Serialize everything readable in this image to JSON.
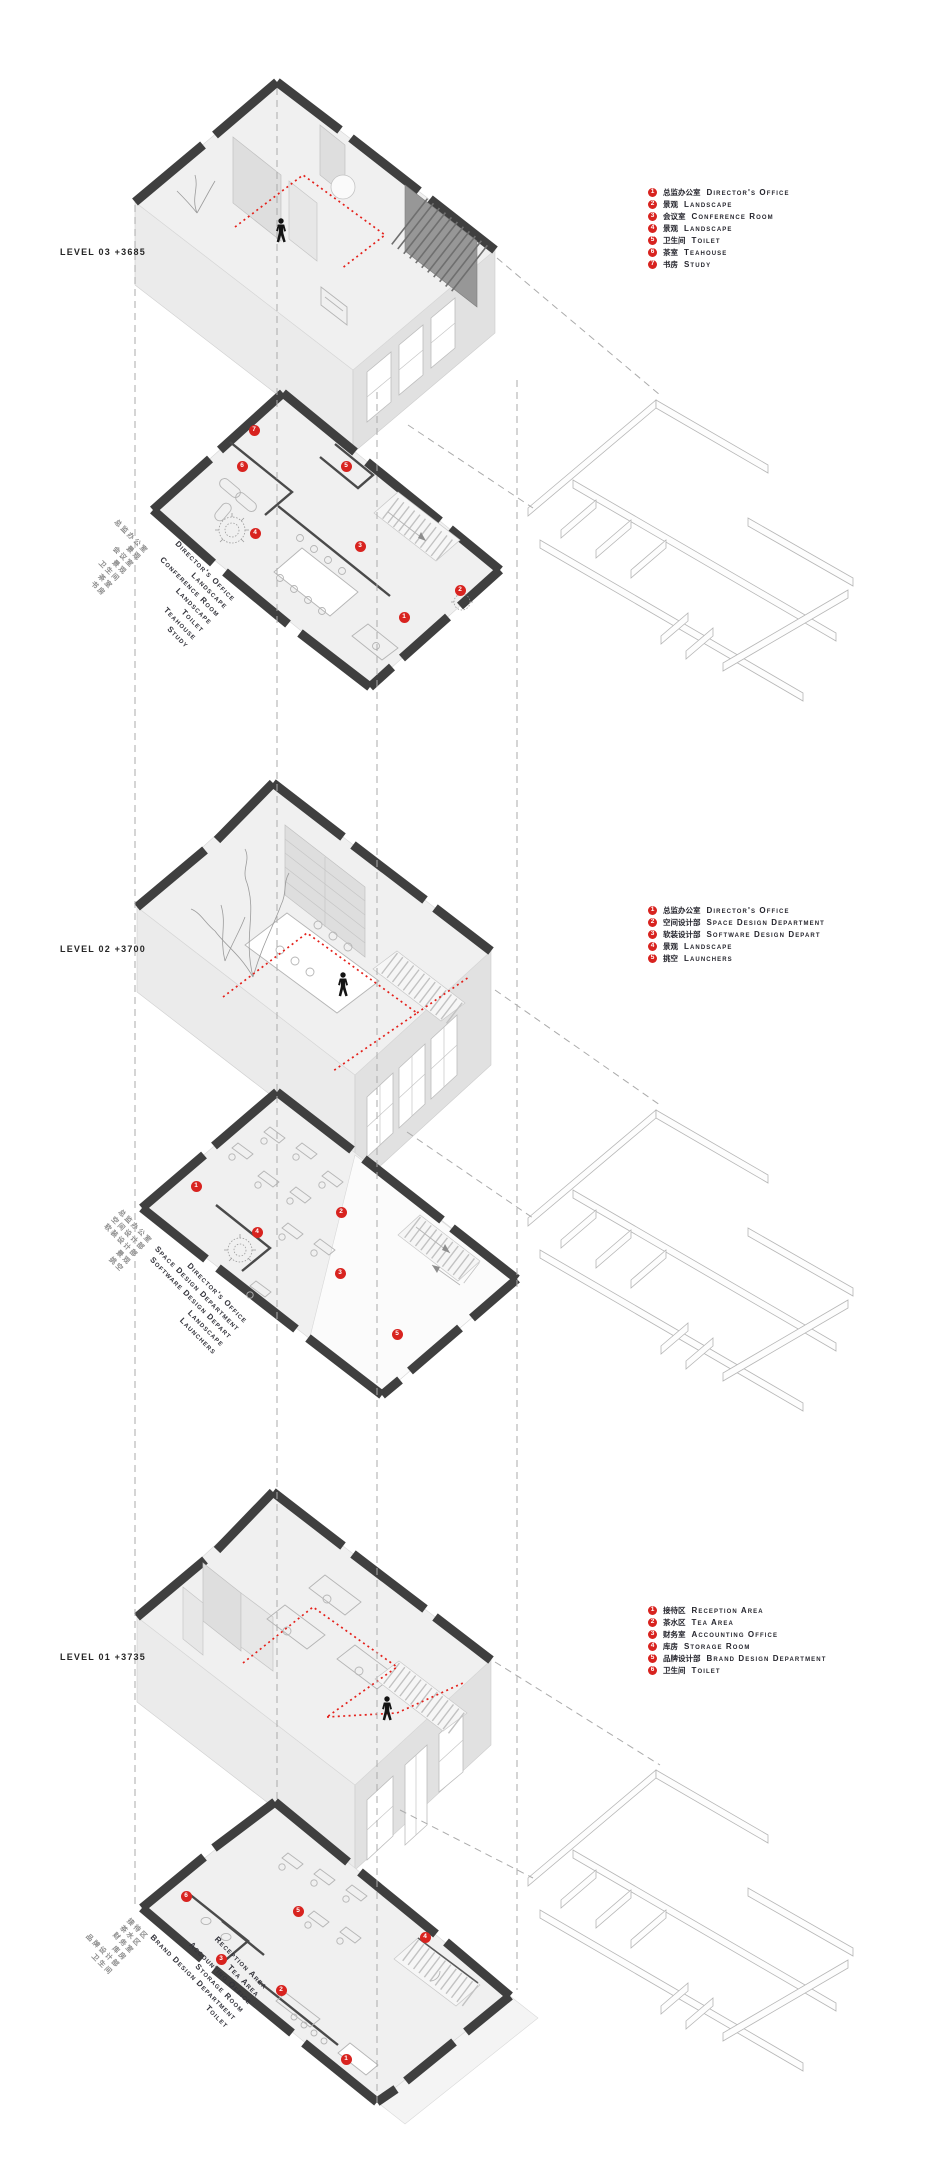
{
  "colors": {
    "marker_red": "#d8231f",
    "wall_dark": "#3f3f3f",
    "path_red": "#e4211b",
    "dash_gray": "#ababab"
  },
  "levels": [
    {
      "id": "level-03",
      "level_label": "LEVEL 03 +3685",
      "legend": [
        {
          "n": "1",
          "zh": "总监办公室",
          "en": "Director's Office"
        },
        {
          "n": "2",
          "zh": "景观",
          "en": "Landscape"
        },
        {
          "n": "3",
          "zh": "会议室",
          "en": "Conference Room"
        },
        {
          "n": "4",
          "zh": "景观",
          "en": "Landscape"
        },
        {
          "n": "5",
          "zh": "卫生间",
          "en": "Toilet"
        },
        {
          "n": "6",
          "zh": "茶室",
          "en": "Teahouse"
        },
        {
          "n": "7",
          "zh": "书房",
          "en": "Study"
        }
      ],
      "markers": [
        {
          "n": "1",
          "x": 274,
          "y": 237
        },
        {
          "n": "2",
          "x": 330,
          "y": 210
        },
        {
          "n": "3",
          "x": 230,
          "y": 166
        },
        {
          "n": "4",
          "x": 125,
          "y": 153
        },
        {
          "n": "5",
          "x": 216,
          "y": 86
        },
        {
          "n": "6",
          "x": 112,
          "y": 86
        },
        {
          "n": "7",
          "x": 124,
          "y": 50
        }
      ]
    },
    {
      "id": "level-02",
      "level_label": "LEVEL 02 +3700",
      "legend": [
        {
          "n": "1",
          "zh": "总监办公室",
          "en": "Director's Office"
        },
        {
          "n": "2",
          "zh": "空间设计部",
          "en": "Space Design Department"
        },
        {
          "n": "3",
          "zh": "软装设计部",
          "en": "Software Design Depart"
        },
        {
          "n": "4",
          "zh": "景观",
          "en": "Landscape"
        },
        {
          "n": "5",
          "zh": "挑空",
          "en": "Launchers"
        }
      ],
      "markers": [
        {
          "n": "1",
          "x": 76,
          "y": 101
        },
        {
          "n": "2",
          "x": 221,
          "y": 127
        },
        {
          "n": "3",
          "x": 220,
          "y": 188
        },
        {
          "n": "4",
          "x": 137,
          "y": 147
        },
        {
          "n": "5",
          "x": 277,
          "y": 249
        }
      ]
    },
    {
      "id": "level-01",
      "level_label": "LEVEL 01 +3735",
      "legend": [
        {
          "n": "1",
          "zh": "接待区",
          "en": "Reception Area"
        },
        {
          "n": "2",
          "zh": "茶水区",
          "en": "Tea Area"
        },
        {
          "n": "3",
          "zh": "财务室",
          "en": "Accounting Office"
        },
        {
          "n": "4",
          "zh": "库房",
          "en": "Storage Room"
        },
        {
          "n": "5",
          "zh": "品牌设计部",
          "en": "Brand Design Department"
        },
        {
          "n": "6",
          "zh": "卫生间",
          "en": "Toilet"
        }
      ],
      "markers": [
        {
          "n": "1",
          "x": 228,
          "y": 266
        },
        {
          "n": "2",
          "x": 163,
          "y": 197
        },
        {
          "n": "3",
          "x": 103,
          "y": 166
        },
        {
          "n": "4",
          "x": 307,
          "y": 144
        },
        {
          "n": "5",
          "x": 180,
          "y": 118
        },
        {
          "n": "6",
          "x": 68,
          "y": 103
        }
      ]
    }
  ]
}
